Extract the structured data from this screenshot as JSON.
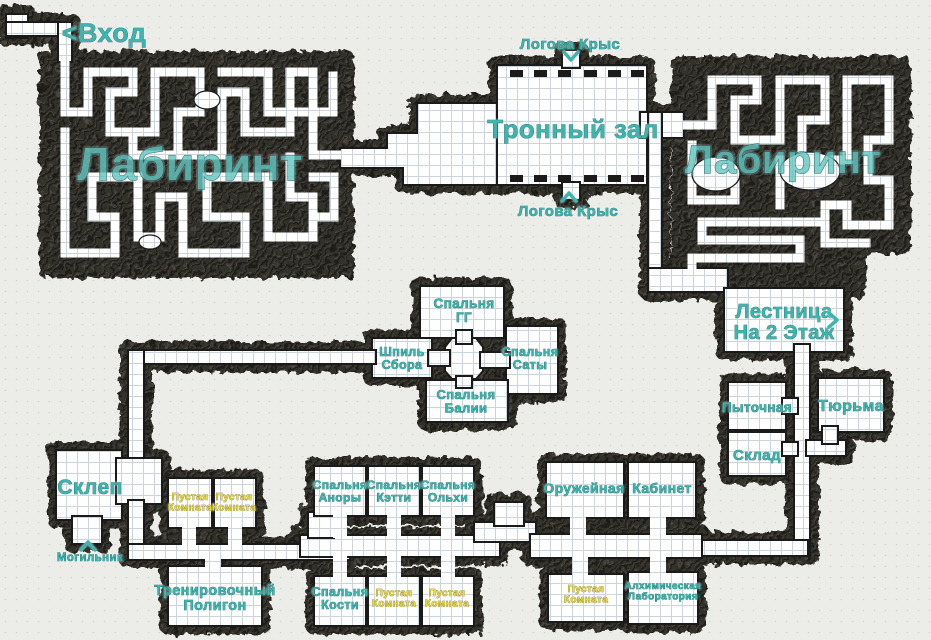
{
  "map": {
    "colors": {
      "paper": "#ecece9",
      "paper_dot": "#d4d4d1",
      "wall": "#33302c",
      "wall_dark": "#1c1b19",
      "wall_light": "#55504a",
      "floor": "#ffffff",
      "grid": "#ccd4db",
      "outline": "#1a1a1a",
      "teal": "#3db4ae",
      "teal_big": "#66c6c1",
      "teal_dark": "#145f5b",
      "yellow": "#e9dd3a",
      "yellow_dark": "#70680f"
    },
    "labels": [
      {
        "id": "entrance",
        "lines": [
          "<Вход"
        ],
        "x": 104,
        "y": 42,
        "size": 27,
        "color": "teal"
      },
      {
        "id": "labyrinth-left",
        "lines": [
          "Лабиринт"
        ],
        "x": 190,
        "y": 180,
        "size": 46,
        "color": "teal_big",
        "opacity": 0.82
      },
      {
        "id": "labyrinth-right",
        "lines": [
          "Лабиринт"
        ],
        "x": 783,
        "y": 173,
        "size": 40,
        "color": "teal_big",
        "opacity": 0.82
      },
      {
        "id": "throne-hall",
        "lines": [
          "Тронный зал"
        ],
        "x": 573,
        "y": 138,
        "size": 26,
        "color": "teal"
      },
      {
        "id": "rat-lair-top",
        "lines": [
          "Логова Крыс"
        ],
        "x": 570,
        "y": 49,
        "size": 15,
        "color": "teal"
      },
      {
        "id": "rat-lair-bottom",
        "lines": [
          "Логова Крыс"
        ],
        "x": 568,
        "y": 216,
        "size": 15,
        "color": "teal"
      },
      {
        "id": "stairs",
        "lines": [
          "Лестница",
          "На 2 Этаж"
        ],
        "x": 784,
        "y": 318,
        "size": 20,
        "color": "teal"
      },
      {
        "id": "torture-room",
        "lines": [
          "Пыточная"
        ],
        "x": 757,
        "y": 412,
        "size": 13.5,
        "color": "teal"
      },
      {
        "id": "prison",
        "lines": [
          "Тюрьма"
        ],
        "x": 851,
        "y": 411,
        "size": 16,
        "color": "teal"
      },
      {
        "id": "storage",
        "lines": [
          "Склад"
        ],
        "x": 757,
        "y": 460,
        "size": 15,
        "color": "teal"
      },
      {
        "id": "crypt",
        "lines": [
          "Склеп"
        ],
        "x": 90,
        "y": 494,
        "size": 21,
        "color": "teal"
      },
      {
        "id": "burial-ground",
        "lines": [
          "Могильник"
        ],
        "x": 90,
        "y": 561,
        "size": 11.5,
        "color": "teal"
      },
      {
        "id": "empty-room-1",
        "lines": [
          "Пустая",
          "Комната"
        ],
        "x": 190,
        "y": 500,
        "size": 10,
        "color": "yellow"
      },
      {
        "id": "empty-room-2",
        "lines": [
          "Пустая",
          "Комната"
        ],
        "x": 234,
        "y": 500,
        "size": 10,
        "color": "yellow"
      },
      {
        "id": "training-ground",
        "lines": [
          "Тренировочный",
          "Полигон"
        ],
        "x": 215,
        "y": 595,
        "size": 14.5,
        "color": "teal"
      },
      {
        "id": "bedroom-gg",
        "lines": [
          "Спальня",
          "ГГ"
        ],
        "x": 464,
        "y": 308,
        "size": 13.5,
        "color": "teal"
      },
      {
        "id": "gathering-spire",
        "lines": [
          "Шпиль",
          "Сбора"
        ],
        "x": 402,
        "y": 356,
        "size": 12.5,
        "color": "teal"
      },
      {
        "id": "bedroom-sata",
        "lines": [
          "Спальня",
          "Саты"
        ],
        "x": 530,
        "y": 356,
        "size": 12.5,
        "color": "teal"
      },
      {
        "id": "bedroom-balia",
        "lines": [
          "Спальня",
          "Балии"
        ],
        "x": 466,
        "y": 399,
        "size": 13,
        "color": "teal"
      },
      {
        "id": "bedroom-anora",
        "lines": [
          "Спальня",
          "Аноры"
        ],
        "x": 340,
        "y": 489,
        "size": 12,
        "color": "teal"
      },
      {
        "id": "bedroom-ketty",
        "lines": [
          "Спальня",
          "Кэтти"
        ],
        "x": 394,
        "y": 489,
        "size": 12,
        "color": "teal"
      },
      {
        "id": "bedroom-olha",
        "lines": [
          "Спальня",
          "Ольхи"
        ],
        "x": 448,
        "y": 489,
        "size": 12,
        "color": "teal"
      },
      {
        "id": "bedroom-kostya",
        "lines": [
          "Спальня",
          "Кости"
        ],
        "x": 340,
        "y": 596,
        "size": 12.5,
        "color": "teal"
      },
      {
        "id": "empty-room-3",
        "lines": [
          "Пустая",
          "Комната"
        ],
        "x": 394,
        "y": 596,
        "size": 10,
        "color": "yellow"
      },
      {
        "id": "empty-room-4",
        "lines": [
          "Пустая",
          "Комната"
        ],
        "x": 447,
        "y": 596,
        "size": 10,
        "color": "yellow"
      },
      {
        "id": "armory",
        "lines": [
          "Оружейная"
        ],
        "x": 584,
        "y": 493,
        "size": 14,
        "color": "teal"
      },
      {
        "id": "cabinet",
        "lines": [
          "Кабинет"
        ],
        "x": 662,
        "y": 493,
        "size": 14,
        "color": "teal"
      },
      {
        "id": "empty-room-5",
        "lines": [
          "Пустая",
          "Комната"
        ],
        "x": 586,
        "y": 592,
        "size": 10,
        "color": "yellow"
      },
      {
        "id": "alchemy-lab",
        "lines": [
          "Алхимическая",
          "Лаборатория"
        ],
        "x": 663,
        "y": 589,
        "size": 10,
        "color": "teal"
      }
    ],
    "arrows": [
      {
        "id": "rat-lair-top-arrow",
        "dir": "down",
        "x": 571,
        "y": 56
      },
      {
        "id": "rat-lair-bottom-arrow",
        "dir": "up",
        "x": 569,
        "y": 197
      },
      {
        "id": "burial-ground-arrow",
        "dir": "up",
        "x": 88,
        "y": 546
      },
      {
        "id": "stairs-arrow",
        "dir": "right",
        "x": 833,
        "y": 320
      }
    ]
  }
}
